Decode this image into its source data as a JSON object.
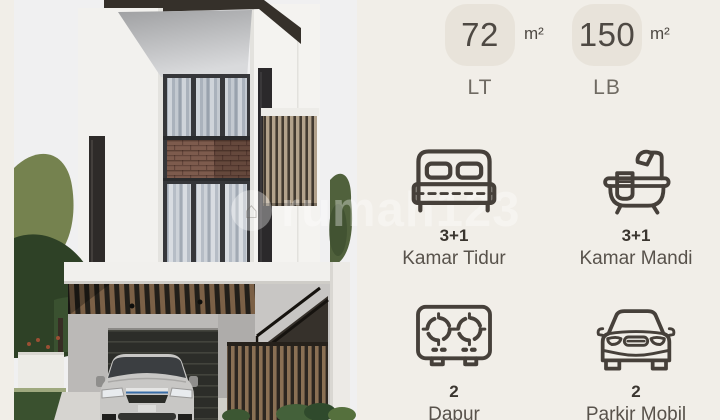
{
  "watermark": {
    "brand": "rumah123"
  },
  "areas": {
    "land": {
      "value": "72",
      "unit": "m²",
      "label": "LT"
    },
    "building": {
      "value": "150",
      "unit": "m²",
      "label": "LB"
    }
  },
  "features": {
    "bedroom": {
      "count": "3+1",
      "label": "Kamar Tidur"
    },
    "bathroom": {
      "count": "3+1",
      "label": "Kamar Mandi"
    },
    "kitchen": {
      "count": "2",
      "label": "Dapur"
    },
    "parking": {
      "count": "2",
      "label": "Parkir Mobil"
    }
  },
  "colors": {
    "panel_background": "#f1eee8",
    "card_background": "#e8e3da",
    "text_primary": "#4e4943",
    "text_secondary": "#6f6a62",
    "icon_stroke": "#46403a"
  }
}
